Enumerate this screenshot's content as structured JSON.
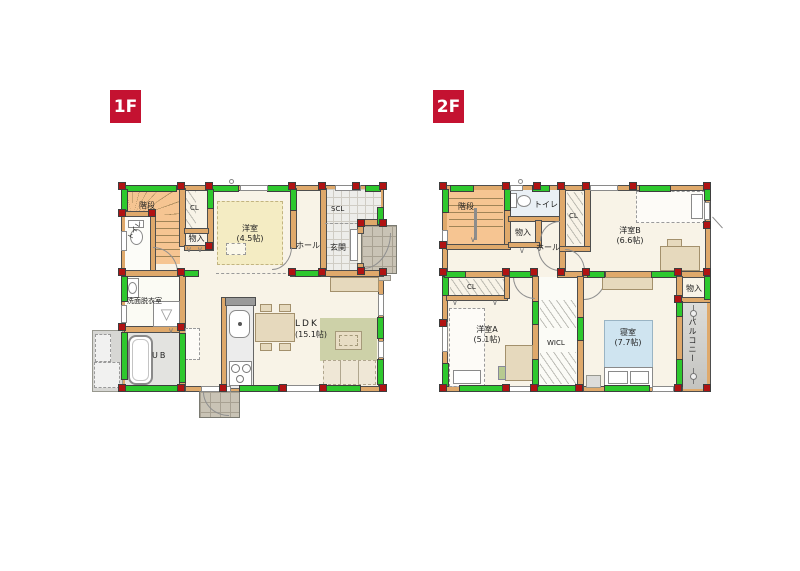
{
  "colors": {
    "badge_bg": "#c41231",
    "badge_text": "#ffffff",
    "wall_wood": "#dfa96b",
    "brace_green": "#2ec82e",
    "pillar_red": "#b01313",
    "floor_cream": "#f8f3e7",
    "tatami_yellow": "#f4ecc3",
    "stairs_orange": "#f6c592",
    "rug_olive": "#cdd1a8",
    "bed_blue": "#cfe4f0",
    "entry_tile": "#ededea"
  },
  "symbols": {
    "bifold": "∨",
    "washer": "▽"
  },
  "f1": {
    "badge": "1F",
    "stairs": "階段",
    "toilet": "トイレ",
    "cl": "CL",
    "monoire": "物入",
    "yoshitsu": "洋室",
    "yoshitsu_size": "(4.5帖)",
    "hall": "ホール",
    "scl": "SCL",
    "genkan": "玄関",
    "senmen": "洗面脱衣室",
    "ub": "UB",
    "ldk": "LDK",
    "ldk_size": "(15.1帖)"
  },
  "f2": {
    "badge": "2F",
    "stairs": "階段",
    "toilet": "トイレ",
    "monoire": "物入",
    "hall": "ホール",
    "cl_upper": "CL",
    "yoshitsu_b": "洋室B",
    "yoshitsu_b_size": "(6.6帖)",
    "cl_lower": "CL",
    "yoshitsu_a": "洋室A",
    "yoshitsu_a_size": "(5.1帖)",
    "wicl": "WICL",
    "shinshitsu": "寝室",
    "shinshitsu_size": "(7.7帖)",
    "monoire2": "物入",
    "balcony": "バルコニー"
  }
}
